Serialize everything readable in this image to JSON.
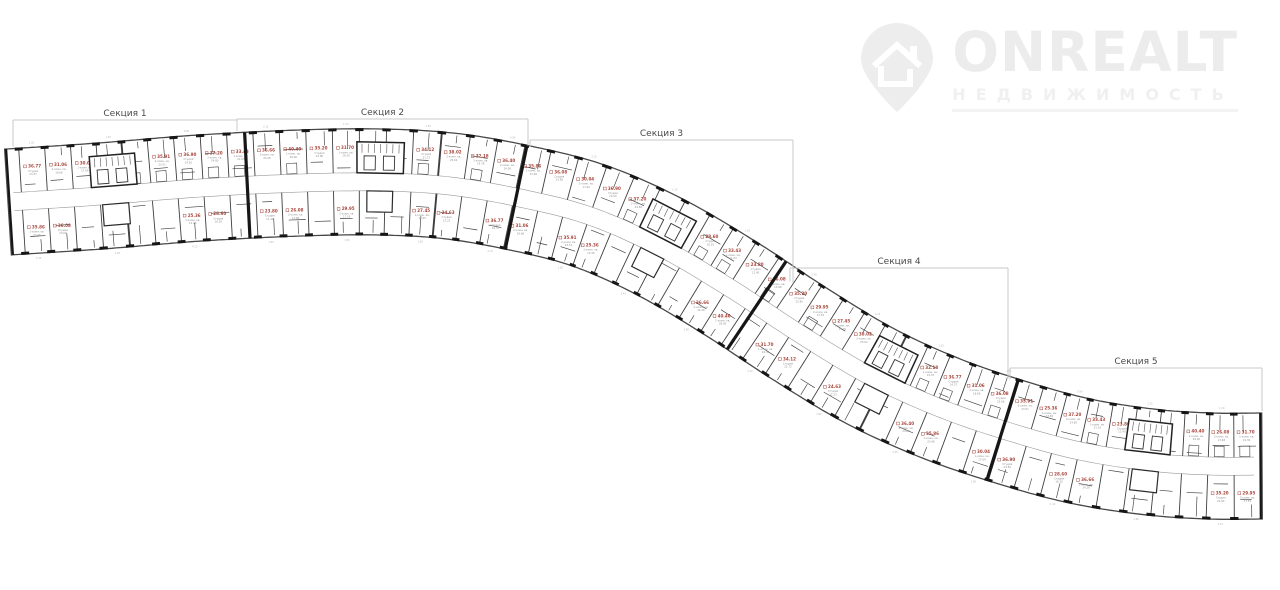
{
  "logo": {
    "brand": "ONREALT",
    "sub": "НЕДВИЖИМОСТЬ",
    "color": "#ececec",
    "sub_color": "#f0f0f0"
  },
  "sections": [
    {
      "label": "Секция 1",
      "x1": 13,
      "x2": 237,
      "y": 120
    },
    {
      "label": "Секция 2",
      "x1": 237,
      "x2": 528,
      "y": 119
    },
    {
      "label": "Секция 3",
      "x1": 530,
      "x2": 793,
      "y": 140
    },
    {
      "label": "Секция 4",
      "x1": 790,
      "x2": 1008,
      "y": 268
    },
    {
      "label": "Секция 5",
      "x1": 1010,
      "x2": 1262,
      "y": 368
    }
  ],
  "plan": {
    "wall_color": "#3f3f3f",
    "thick_wall_color": "#161616",
    "outline_color": "#474747",
    "corridor_color": "#9a9a9a",
    "area_label_color": "#a8463c",
    "muted_text_color": "#909090",
    "dim_text_color": "#b5b5b5",
    "bracket_color": "#c8c8c8",
    "section_label_color": "#4a4a4a",
    "unit_areas": [
      "36.77",
      "35.86",
      "31.06",
      "36.08",
      "30.04",
      "35.91",
      "36.90",
      "25.36",
      "37.20",
      "28.60",
      "33.43",
      "36.66",
      "23.80",
      "40.40",
      "26.08",
      "35.20",
      "31.70",
      "29.95",
      "34.12",
      "27.45",
      "38.02",
      "24.63",
      "32.18",
      "36.40"
    ],
    "unit_types": [
      "Студия",
      "1-комн. кв.",
      "2-комн. кв."
    ],
    "edge_dim_labels": [
      "1.20",
      "3.45",
      "1.50",
      "2.80",
      "0.90",
      "4.10",
      "2.15",
      "1.80"
    ]
  }
}
